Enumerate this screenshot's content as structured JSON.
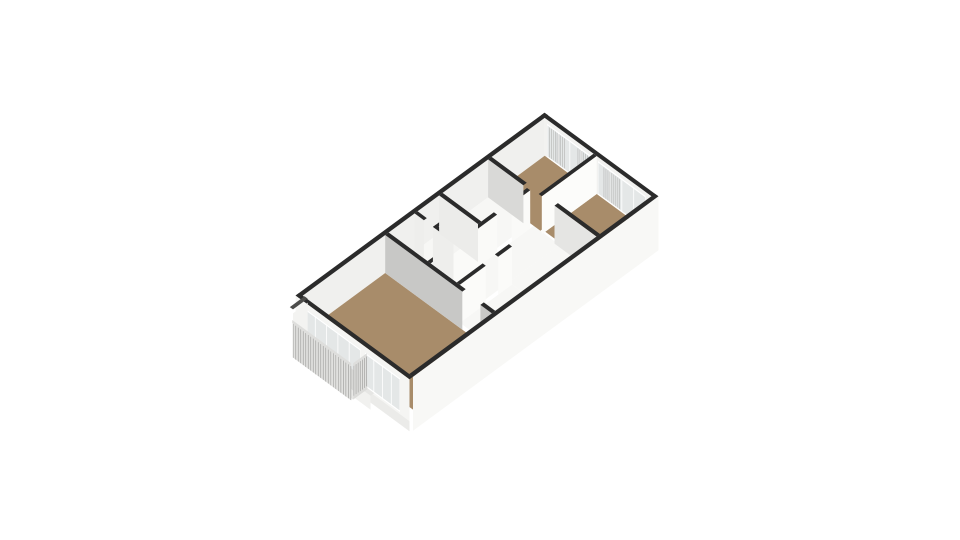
{
  "meta": {
    "title": "3D axonometric floor plan of an apartment",
    "canvas_width": 960,
    "canvas_height": 540,
    "background": "#ffffff"
  },
  "palette": {
    "cap": "#2b2b2b",
    "cap_soft": "#4c4c4a",
    "floor_wood": "#a88c6a",
    "floor_white": "#f7f7f5",
    "floor_balcony": "#d8d8d6",
    "glazing": "#e4e7e7",
    "mullion": "#ffffff",
    "stripe": "#a9a9a7",
    "slat": "#a2a2a0",
    "slat_bg": "#e1e1df",
    "rail_top": "#dededc",
    "slab_front": "#e8e8e6",
    "slab_side": "#dcdcda"
  },
  "projection": {
    "origin": [
      300,
      293
    ],
    "u": [
      24.5,
      -18
    ],
    "v": [
      22.6,
      16.6
    ],
    "floor_z": 38,
    "wall_h": 38
  },
  "exterior": {
    "nw_wall": {
      "cap": {
        "a1": -0.16,
        "a2": 10.0,
        "b1": -0.02,
        "b2": 0.14
      },
      "face": {
        "a1": -0.02,
        "a2": 9.86,
        "b": 0.14,
        "z1": 0,
        "z2": 38,
        "color": "#f0f0ee"
      }
    },
    "ne_wall": {
      "cap": {
        "a1": 9.86,
        "a2": 10.0,
        "b1": -0.02,
        "b2": 5.0
      },
      "face": {
        "a": 9.86,
        "b1": 0.14,
        "b2": 4.86,
        "z1": 0,
        "z2": 38,
        "color": "#f2f2f0"
      },
      "glazing": [
        {
          "b1": 0.25,
          "b2": 2.25,
          "z1": 4,
          "z2": 38,
          "mullions": 3
        },
        {
          "b1": 2.5,
          "b2": 4.6,
          "z1": 4,
          "z2": 38,
          "mullions": 3
        }
      ],
      "stripes": [
        {
          "b1": 0.35,
          "b2": 1.0,
          "count": 9
        },
        {
          "b1": 1.6,
          "b2": 2.2,
          "count": 8
        },
        {
          "b1": 2.75,
          "b2": 3.45,
          "count": 9
        }
      ]
    },
    "se_panel": {
      "cap": {
        "a1": -0.02,
        "a2": 10.0,
        "b1": 4.86,
        "b2": 5.02
      },
      "face": {
        "a1": -0.02,
        "a2": 10.0,
        "b": 5.02,
        "z1": 0,
        "z2": 54,
        "color": "#f8f8f6"
      }
    },
    "sw_wall": {
      "cap": {
        "a1": -0.16,
        "a2": -0.02,
        "b1": -0.02,
        "b2": 5.02
      },
      "face": {
        "a": -0.16,
        "b1": -0.02,
        "b2": 5.02,
        "z1": 0,
        "z2": 52,
        "color": "#f5f5f3"
      },
      "lower_band": {
        "z1": 42,
        "z2": 52,
        "color": "#ebebe9"
      },
      "glazing": [
        {
          "b1": 0.35,
          "b2": 2.85,
          "z1": 6,
          "z2": 42,
          "mullions": 4
        },
        {
          "b1": 3.05,
          "b2": 4.6,
          "z1": 6,
          "z2": 40,
          "mullions": 3
        }
      ],
      "threshold": {
        "a": -0.3,
        "b1": 2.05,
        "b2": 3.45,
        "z1": 40,
        "z2": 54,
        "color": "#f1f1ef",
        "top": "#e6e6e4"
      }
    }
  },
  "floors": [
    {
      "name": "living-room",
      "a1": 0.12,
      "a2": 3.35,
      "b1": 0.14,
      "b2": 4.86,
      "color": "#a88c6a"
    },
    {
      "name": "bathroom",
      "a1": 3.49,
      "a2": 4.55,
      "b1": 0.14,
      "b2": 1.86,
      "color": "#f9f9f7"
    },
    {
      "name": "toilet",
      "a1": 4.55,
      "a2": 5.55,
      "b1": 0.14,
      "b2": 1.86,
      "color": "#f7f7f5"
    },
    {
      "name": "study",
      "a1": 5.69,
      "a2": 7.69,
      "b1": 0.14,
      "b2": 1.86,
      "color": "#f7f7f5"
    },
    {
      "name": "hallway",
      "a1": 3.49,
      "a2": 7.69,
      "b1": 2.0,
      "b2": 3.15,
      "color": "#f7f7f5"
    },
    {
      "name": "entrance-hall",
      "a1": 5.62,
      "a2": 7.76,
      "b1": 3.15,
      "b2": 4.86,
      "color": "#f7f7f5"
    },
    {
      "name": "storage",
      "a1": 3.49,
      "a2": 5.62,
      "b1": 3.29,
      "b2": 4.86,
      "color": "#f7f7f5"
    },
    {
      "name": "bedroom-1",
      "a1": 7.69,
      "a2": 9.86,
      "b1": 0.14,
      "b2": 2.3,
      "color": "#a88c6a"
    },
    {
      "name": "bedroom-2",
      "a1": 7.76,
      "a2": 9.86,
      "b1": 2.44,
      "b2": 4.86,
      "color": "#a88c6a"
    }
  ],
  "walls_along_length": [
    {
      "name": "bathroom-south-wall",
      "b": 1.86,
      "t": 0.14,
      "h": 38,
      "face": "#fafaf8",
      "spans": [
        [
          3.49,
          3.85
        ],
        [
          4.4,
          6.2
        ],
        [
          6.8,
          7.55
        ]
      ]
    },
    {
      "name": "toilet-divider-wall",
      "b": 0.95,
      "t": 0.12,
      "h": 38,
      "face": "#f4f4f2",
      "spans": [
        [
          4.55,
          5.55
        ]
      ]
    },
    {
      "name": "bedroom-divider-wall",
      "b": 2.3,
      "t": 0.14,
      "h": 38,
      "face": "#fcfcfa",
      "spans": [
        [
          7.62,
          9.86
        ]
      ]
    },
    {
      "name": "hallway-south-wall",
      "b": 3.15,
      "t": 0.14,
      "h": 38,
      "face": "#fbfbf9",
      "spans": [
        [
          3.49,
          4.55
        ],
        [
          5.05,
          5.62
        ]
      ]
    }
  ],
  "walls_along_width": [
    {
      "name": "living-room-separator-wall",
      "a": 3.35,
      "t": 0.14,
      "h": 38,
      "face": "#c8c8c6",
      "spans": [
        [
          0.14,
          3.55
        ],
        [
          4.35,
          4.86
        ]
      ]
    },
    {
      "name": "bathroom-divider-wall",
      "a": 4.55,
      "t": 0.12,
      "h": 38,
      "face": "#eeeeec",
      "spans": [
        [
          0.14,
          0.55
        ],
        [
          0.95,
          1.86
        ]
      ]
    },
    {
      "name": "study-west-wall",
      "a": 5.55,
      "t": 0.14,
      "h": 38,
      "face": "#ececea",
      "spans": [
        [
          0.14,
          1.86
        ]
      ]
    },
    {
      "name": "bedroom1-west-wall",
      "a": 7.55,
      "t": 0.14,
      "h": 38,
      "face": "#d9d9d7",
      "spans": [
        [
          0.14,
          1.7
        ]
      ]
    },
    {
      "name": "bedroom2-west-wall",
      "a": 7.62,
      "t": 0.14,
      "h": 38,
      "face": "#e5e5e3",
      "spans": [
        [
          3.0,
          4.86
        ]
      ]
    }
  ],
  "balcony": {
    "privacy_panel": {
      "a1": -0.6,
      "a2": 0.0,
      "b": 0.2,
      "t": 0.14,
      "z1": 4,
      "z2": 38,
      "face": "#f3f3f1"
    },
    "floor": {
      "a1": -0.6,
      "a2": -0.02,
      "b1": 0.34,
      "b2": 3.0,
      "z": 37,
      "color": "#d8d8d6"
    },
    "slab_front": {
      "z1": 37,
      "z2": 46
    },
    "slab_side": {
      "z1": 37,
      "z2": 46
    },
    "railing_front": {
      "a": -0.66,
      "b1": 0.4,
      "b2": 2.95,
      "z1": 12,
      "z2": 46,
      "count": 24
    },
    "railing_side": {
      "b": 3.02,
      "a1": -0.6,
      "a2": -0.08,
      "z1": 12,
      "z2": 42,
      "count": 7
    },
    "rail_top_z": 9
  }
}
